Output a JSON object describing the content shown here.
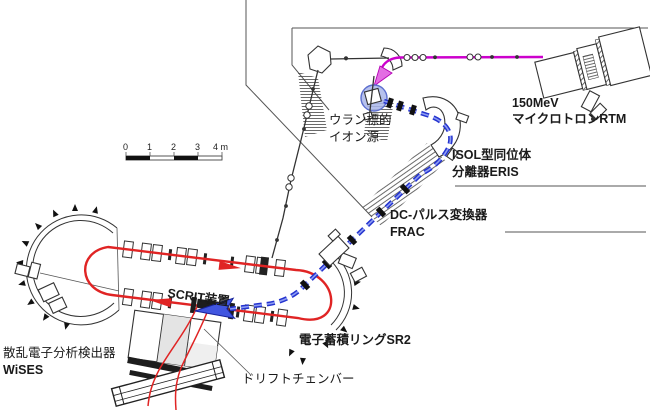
{
  "labels": {
    "rtm": {
      "line1": "150MeV",
      "line2": "マイクロトロンRTM"
    },
    "uranium_ion_source": {
      "line1": "ウラン標的",
      "line2": "イオン源"
    },
    "eris": {
      "line1": "ISOL型同位体",
      "line2": "分離器ERIS"
    },
    "frac": {
      "line1": "DC-パルス変換器",
      "line2": "FRAC"
    },
    "scrit": {
      "line1": "SCRIT装置"
    },
    "sr2": {
      "line1": "電子蓄積リングSR2"
    },
    "wises": {
      "line1": "散乱電子分析検出器",
      "line2": "WiSES"
    },
    "drift_chamber": {
      "line1": "ドリフトチェンバー"
    }
  },
  "scale_bar": {
    "tick0": "0",
    "tick1": "1",
    "tick2": "2",
    "tick3": "3",
    "tick4": "4 m"
  },
  "colors": {
    "electron_driver_beam": "#cc00cc",
    "driver_arrow": "#e36ee3",
    "ion_beam": "#2433cf",
    "injection_arrow": "#4156e0",
    "stored_electron_beam": "#e02424",
    "ion_source_fill": "#a9b6ea",
    "detector_shade": "#e4e4e4",
    "wall_line": "#555555"
  }
}
